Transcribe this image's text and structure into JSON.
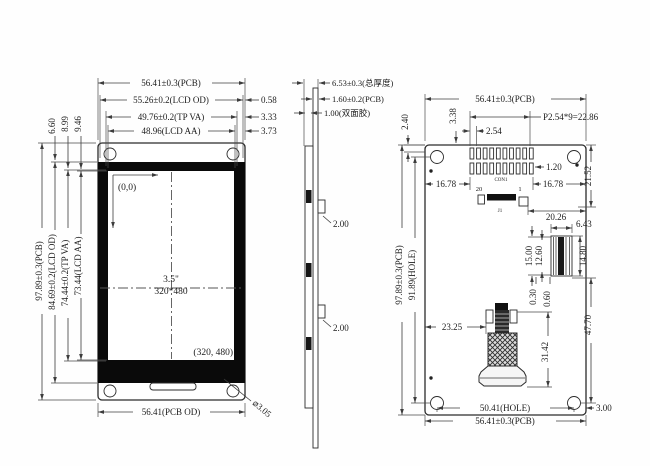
{
  "shared": {
    "pcb_w": "56.41±0.3(PCB)",
    "pcb_h": "97.89±0.3(PCB)"
  },
  "front": {
    "lcd_od_w": "55.26±0.2(LCD OD)",
    "tp_va_w": "49.76±0.2(TP VA)",
    "lcd_aa_w": "48.96(LCD AA)",
    "offset_od": "0.58",
    "offset_tp": "3.33",
    "offset_aa": "3.73",
    "top_gap_od": "6.60",
    "top_gap_tp": "8.99",
    "top_gap_aa": "9.46",
    "lcd_od_h": "84.69±0.2(LCD OD)",
    "tp_va_h": "74.44±0.2(TP VA)",
    "lcd_aa_h": "73.44(LCD AA)",
    "origin": "(0,0)",
    "size": "3.5\"",
    "resolution": "320*480",
    "corner_coord": "(320, 480)",
    "pcb_od_w": "56.41(PCB OD)",
    "hole_dia": "⌀3.05"
  },
  "side": {
    "total_thickness": "6.53±0.3(总厚度)",
    "pcb_thickness": "1.60±0.2(PCB)",
    "tape_thickness": "1.00(双面胶)",
    "tab_upper": "2.00",
    "tab_lower": "2.00"
  },
  "back": {
    "pin_pitch_total": "P2.54*9=22.86",
    "pin_pitch": "2.54",
    "edge_gap_top": "3.38",
    "edge_gap_left_top": "2.40",
    "pad_width": "1.20",
    "con_height": "21.52",
    "pad_margin_left": "16.78",
    "pad_margin_right": "16.78",
    "fpc_offset": "20.26",
    "con_label": "CON1",
    "pin_20": "20",
    "pin_1": "1",
    "j_label": "J1",
    "hole_h": "91.89(HOLE)",
    "conn_w": "6.43",
    "conn_h": "14.80",
    "conn_len1": "15.00",
    "conn_len2": "12.60",
    "conn_gap1": "0.30",
    "conn_gap2": "0.60",
    "stem_x": "23.25",
    "stem_h": "31.42",
    "right_span": "47.70",
    "hole_w": "50.41(HOLE)",
    "edge_margin": "3.00"
  }
}
